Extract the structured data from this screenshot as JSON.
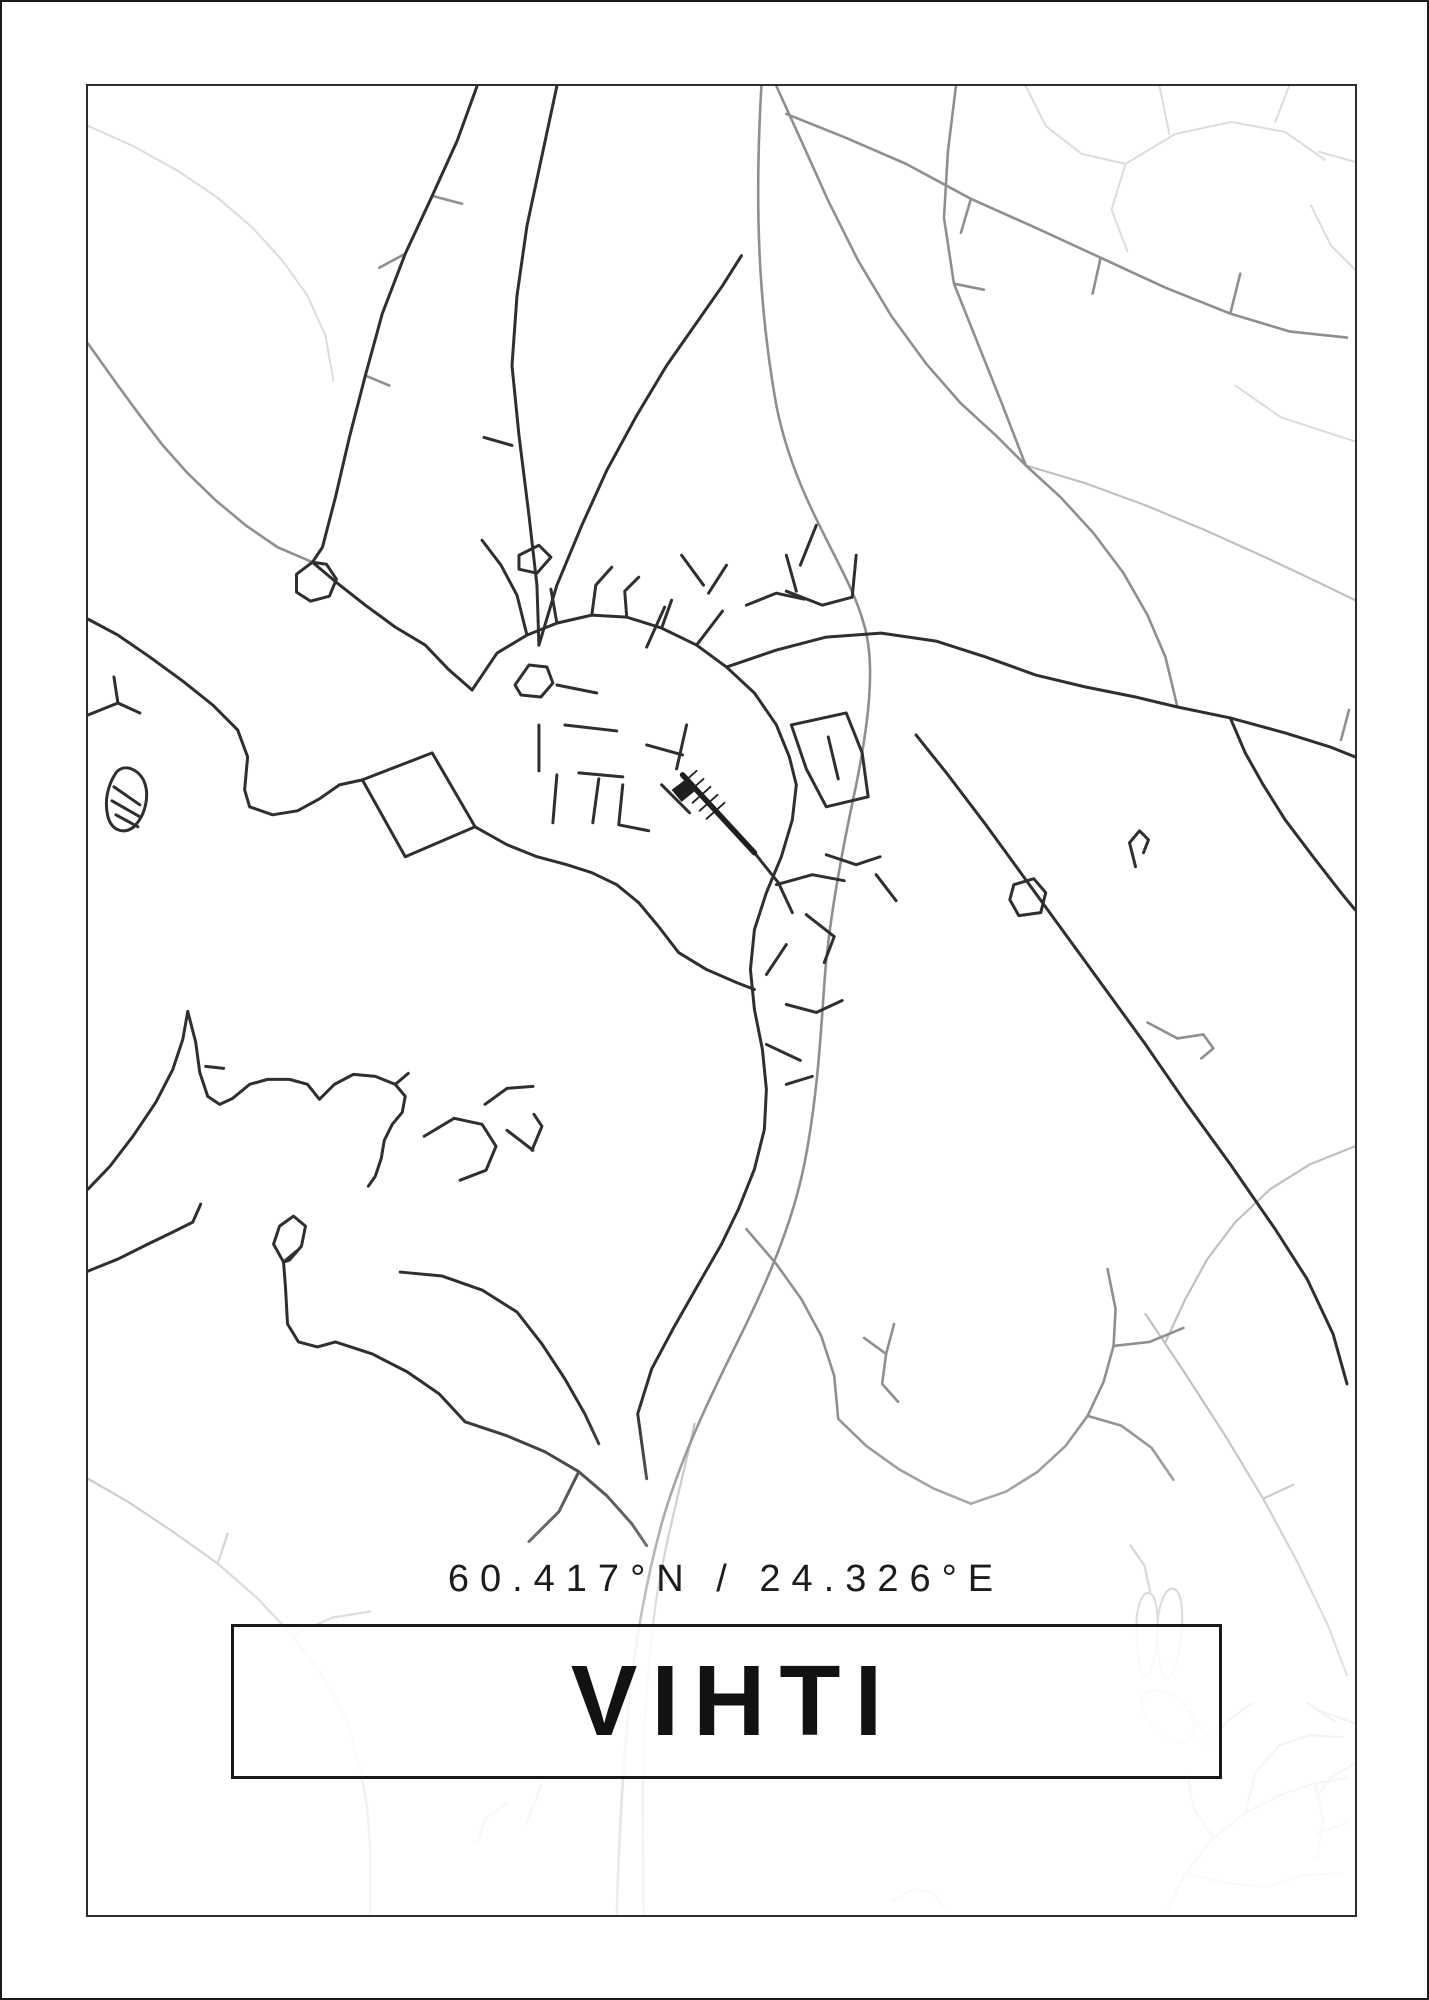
{
  "poster": {
    "coordinates": "60.417°N / 24.326°E",
    "title": "VIHTI"
  },
  "colors": {
    "background": "#ffffff",
    "outer_border": "#1b1b1b",
    "frame_border": "#2e2e2e",
    "road_dark": "#2f2f2f",
    "road_medium": "#8f8f8f",
    "road_light": "#c0c0c0",
    "road_faint": "#dcdcdc",
    "railway": "#1f1f1f",
    "text": "#1c1c1c"
  },
  "map": {
    "viewbox": "0 0 1270 1832",
    "layers": [
      {
        "name": "roads-faint",
        "color": "#dcdcdc",
        "width": 2,
        "paths": [
          "M0,40 L45,60 90,85 130,112 165,142 195,175 220,210 238,250 246,295",
          "M940,0 l20,40 36,28 44,10 M1040,78 l50,-30 56,-12 54,10 40,28 M1084,48 l-10,-48 M1190,36 l14,-36 M1234,66 l36,10 M1040,78 l-14,46 16,42 M1226,120 l20,40 26,26 M1150,300 l46,32 74,24",
          "M1080,1832 L1100,1790 1128,1755 1160,1730 1195,1712 1230,1700 1262,1695 M1128,1755 l-20,-30 -6,-34 M1160,1730 l10,-40 24,-28 M1194,1662 l30,-10 34,2 M1230,1700 l8,36 -6,40 M1262,1740 l-30,10 M1222,1620 l28,18 M1270,1640 l-40,-14 M1100,1790 l40,10 42,4 M1182,1804 l36,-12 38,-2 M1140,1640 l-22,26 M1140,1640 l26,-20",
          "M806,1818 l22,-12 20,4 10,14 M420,1720 l-22,16 -8,24 M455,1700 l-15,40",
          "M1270,1680 l-24,14 -16,22"
        ]
      },
      {
        "name": "roads-light",
        "color": "#c0c0c0",
        "width": 2.2,
        "paths": [
          "M608,1340 C595,1400 578,1460 569,1520 C561,1580 556,1650 556,1720 L557,1832",
          "M1270,1062 L1225,1080 1185,1105 1150,1138 1122,1175 1100,1215 1080,1258",
          "M0,1395 L40,1418 85,1448 130,1480 170,1515 205,1552 235,1592 258,1635 272,1680 280,1725 283,1770 283,1832 M205,1552 l40,-18 38,-6 M130,1480 l10,-30",
          "M1060,1230 L1100,1290 1140,1352 1178,1415 1212,1478 1242,1540 1262,1592 M1178,1415 l30,-14",
          "M940,380 L1000,398 1060,420 1120,445 1180,472 1235,498 1270,515",
          "M1052,1560 C1048,1528 1056,1505 1065,1510 C1074,1516 1074,1550 1068,1580 C1063,1602 1052,1595 1052,1560 z M1072,1558 C1070,1524 1080,1500 1090,1506 C1100,1514 1098,1552 1090,1582 C1083,1606 1073,1595 1072,1558 z M1058,1612 C1072,1600 1096,1612 1106,1632 C1114,1650 1104,1664 1088,1658 C1070,1650 1048,1626 1058,1612 z M1065,1510 l-6,-28 -14,-20 M1106,1632 l16,20"
        ]
      },
      {
        "name": "roads-medium",
        "color": "#8f8f8f",
        "width": 2.6,
        "paths": [
          "M675,0 C668,120 672,220 690,320 C710,420 762,480 778,540 C790,580 782,640 770,700 C755,770 742,840 738,900 C734,960 730,1020 718,1080 C706,1140 680,1200 650,1260 C620,1320 592,1380 575,1440 C560,1495 548,1560 542,1620 C537,1680 532,1750 530,1832",
          "M225,477 L190,462 158,440 128,415 100,388 75,360 52,330 30,300 10,272 0,258",
          "M345,110 l30,8 M318,168 l-26,14 M278,290 l24,10",
          "M690,0 L715,55 742,115 772,175 805,230 840,278 875,318 910,350 940,380",
          "M870,0 L862,65 858,132 868,198 892,258 916,318 940,380 M868,198 l30,6",
          "M940,380 L975,412 1008,448 1038,488 1062,530 1080,572 1092,622",
          "M700,28 L760,52 820,78 885,113 950,142 1015,172 1080,202 1145,228 1205,246 1262,252 M1145,228 l10,-40 M1015,172 l-8,36 M885,113 l-10,34",
          "M1256,655 l8,-30",
          "M1062,938 l30,16 26,-4 10,14 -12,10",
          "M660,1145 L690,1180 715,1215 735,1252 748,1292 752,1335 780,1362 812,1385 848,1405 885,1420",
          "M885,1420 L920,1408 952,1388 980,1362 1002,1332 1018,1298 1028,1262 1030,1225 1022,1185 M1002,1332 l34,10 30,22 22,32 M1028,1262 l36,-4 34,-14",
          "M800,1270 l8,-30 M800,1270 l-22,-16 M800,1270 l-4,30 16,18"
        ]
      },
      {
        "name": "roads-dark",
        "color": "#2f2f2f",
        "width": 3,
        "paths": [
          "M385,605 L410,568 440,550 470,538 505,530 540,532 575,543 610,560 640,582 668,608 690,640 703,672 710,700",
          "M710,700 L706,735 695,772 680,808 668,845 664,885 668,925 676,965 680,1005 678,1045 668,1085 652,1125 635,1160",
          "M640,582 L690,565 740,552 795,548 850,556 900,572 950,590 1000,602 1050,612 1092,622 1145,633 1200,648 1245,662 1270,672",
          "M1145,633 L1160,668 1178,700 1200,735 1228,772 1256,808 1270,825",
          "M830,650 L862,690 900,740 940,795 980,850 1020,905 1060,960 1100,1018 1145,1080 1190,1145 1222,1195 1248,1250 1262,1300",
          "M928,800 l20,-6 12,14 -5,20 -22,3 -9,-16 z",
          "M1050,782 l-6,-24 10,-12 9,9 -5,13",
          "M668,768 L692,798 706,828",
          "M428,600 l14,-20 18,2 6,16 -12,14 -20,-2 z",
          "M470,538 l-6,-34 M505,530 l4,-30 16,-18 M575,543 l10,-28 M540,532 l-2,-26 14,-14",
          "M470,600 l40,8 M478,640 l52,6 M452,640 l0,46 M492,688 l44,4 M470,690 l-4,48 M512,694 l-6,44 M536,700 l-4,40 30,6 M560,660 l36,10 M600,640 l-10,44 M575,700 l28,28",
          "M690,800 l36,-10 32,6 M720,830 l28,22 -10,26 M700,860 l-20,30 M740,770 l30,10 24,-8 M790,790 l20,26 M700,920 l30,8 26,-12 M680,960 l34,16 M700,1000 l26,-8",
          "M705,640 l55,-12 16,40 6,44 -42,10 -20,-38 z M742,652 l10,42",
          "M560,562 l18,-40 M595,470 l22,30 M610,560 l26,-34 M640,480 l-18,28 M660,520 l30,-12 28,6 M700,470 l10,36 M730,440 l-16,40 M700,506 l36,14 30,-8 M770,470 l-4,42",
          "M470,0 L455,70 440,140 430,210 425,280 432,350 442,430 450,500 452,560",
          "M452,560 L470,500 495,440 520,385 550,330 580,280 608,240 636,200 655,170",
          "M432,470 l20,-10 12,12 -14,16 -18,-4 z M425,360 l-28,-8",
          "M390,0 L370,55 345,110 318,168 295,228 278,290 262,352 248,412 235,462 225,477",
          "M225,477 L250,498 278,520 308,542 338,560 362,585 385,605",
          "M225,477 l-16,12 0,18 14,9 19,-5 7,-17 -10,-15 z",
          "M275,695 L345,668 388,742 318,772 z",
          "M0,534 L30,550 62,572 95,596 125,620 150,645 160,672 157,705 162,722 185,730 210,726 232,714 252,700 275,695",
          "M388,742 L420,760 450,772 480,780 505,788 530,800 552,818 572,842 592,868 620,885 650,898 668,905",
          "M0,630 l30,-12 22,10 M30,618 l-4,-26",
          "M28,688 C20,700 16,716 20,732 C24,746 36,750 46,742 C58,730 62,710 56,696 C50,684 36,678 28,688 z",
          "M26,702 l26,18 M24,716 l28,16 M28,730 l22,12",
          "M0,1105 L22,1082 45,1052 68,1018 85,985 95,955 100,927",
          "M100,927 L108,958 112,988 120,1012 132,1020 145,1014 162,1000 180,995 202,995 220,1000 232,1015 M232,1015 L247,1000 266,990 288,992 308,1000 318,1012 315,1028 305,1040 297,1056 294,1074 288,1092 281,1102 M308,1000 l13,-11 M118,982 l18,2",
          "M0,1187 L30,1175 60,1160 85,1148 105,1138 113,1120",
          "M198,1204 L196,1178 186,1160 192,1142 206,1132 218,1142 214,1162 202,1176 196,1178 M196,1178 l13,-11",
          "M198,1204 L200,1240 211,1258 230,1263 248,1258 285,1270 320,1288 352,1310 378,1338",
          "M378,1338 L420,1352 458,1368 492,1388 520,1412 545,1440 560,1462 M492,1388 l-20,40 -30,30",
          "M430,1228 L455,1260 478,1295 498,1330 512,1360 M430,1228 L395,1206 355,1192 313,1188",
          "M337,1052 l30,-18 28,6 14,22 -10,24 -26,10 M398,1020 l22,-16 26,-2 M420,1046 l26,20 M445,1066 l10,-24 -8,-12",
          "M635,1160 L612,1200 588,1242 565,1285 551,1330 560,1395",
          "M440,550 L430,510 414,480 395,455"
        ]
      },
      {
        "name": "railway-line",
        "color": "#1f1f1f",
        "width": 5.5,
        "paths": [
          "M596,690 L668,768"
        ]
      },
      {
        "name": "railway-hatches",
        "color": "#1f1f1f",
        "width": 1.8,
        "paths": [
          "M592,702 l18,-16 M599,710 l18,-16 M606,718 l18,-16 M613,726 l18,-16 M620,734 l18,-16"
        ]
      },
      {
        "name": "station-blob",
        "color": "#1f1f1f",
        "width": 1,
        "fill": true,
        "paths": [
          "M585,705 l16,-12 10,11 -16,13 z"
        ]
      }
    ]
  }
}
